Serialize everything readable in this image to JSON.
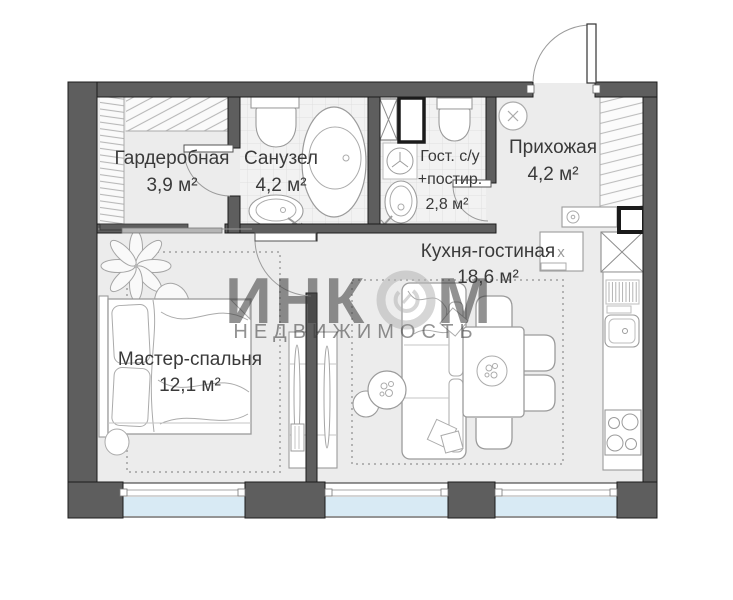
{
  "watermark": {
    "part1": "ИНК",
    "part2": "М",
    "line2": "НЕДВИЖИМОСТЬ"
  },
  "rooms": {
    "wardrobe": {
      "name": "Гардеробная",
      "area": "3,9 м²"
    },
    "bathroom": {
      "name": "Санузел",
      "area": "4,2 м²"
    },
    "guest_wc": {
      "name": "Гост. с/у",
      "name2": "+постир.",
      "area": "2,8 м²"
    },
    "hallway": {
      "name": "Прихожая",
      "area": "4,2 м²"
    },
    "kitchen_living": {
      "name": "Кухня-гостиная",
      "area": "18,6 м²"
    },
    "master_bedroom": {
      "name": "Мастер-спальня",
      "area": "12,1 м²"
    }
  },
  "kitchen": {
    "appliance_label": "х"
  },
  "colors": {
    "wall": "#5e5e5e",
    "floor": "#ececec",
    "tile": "#f2f2f2",
    "window_glass": "#d8eaf4",
    "watermark": "#c6c6c6",
    "furniture_line": "#999999"
  }
}
